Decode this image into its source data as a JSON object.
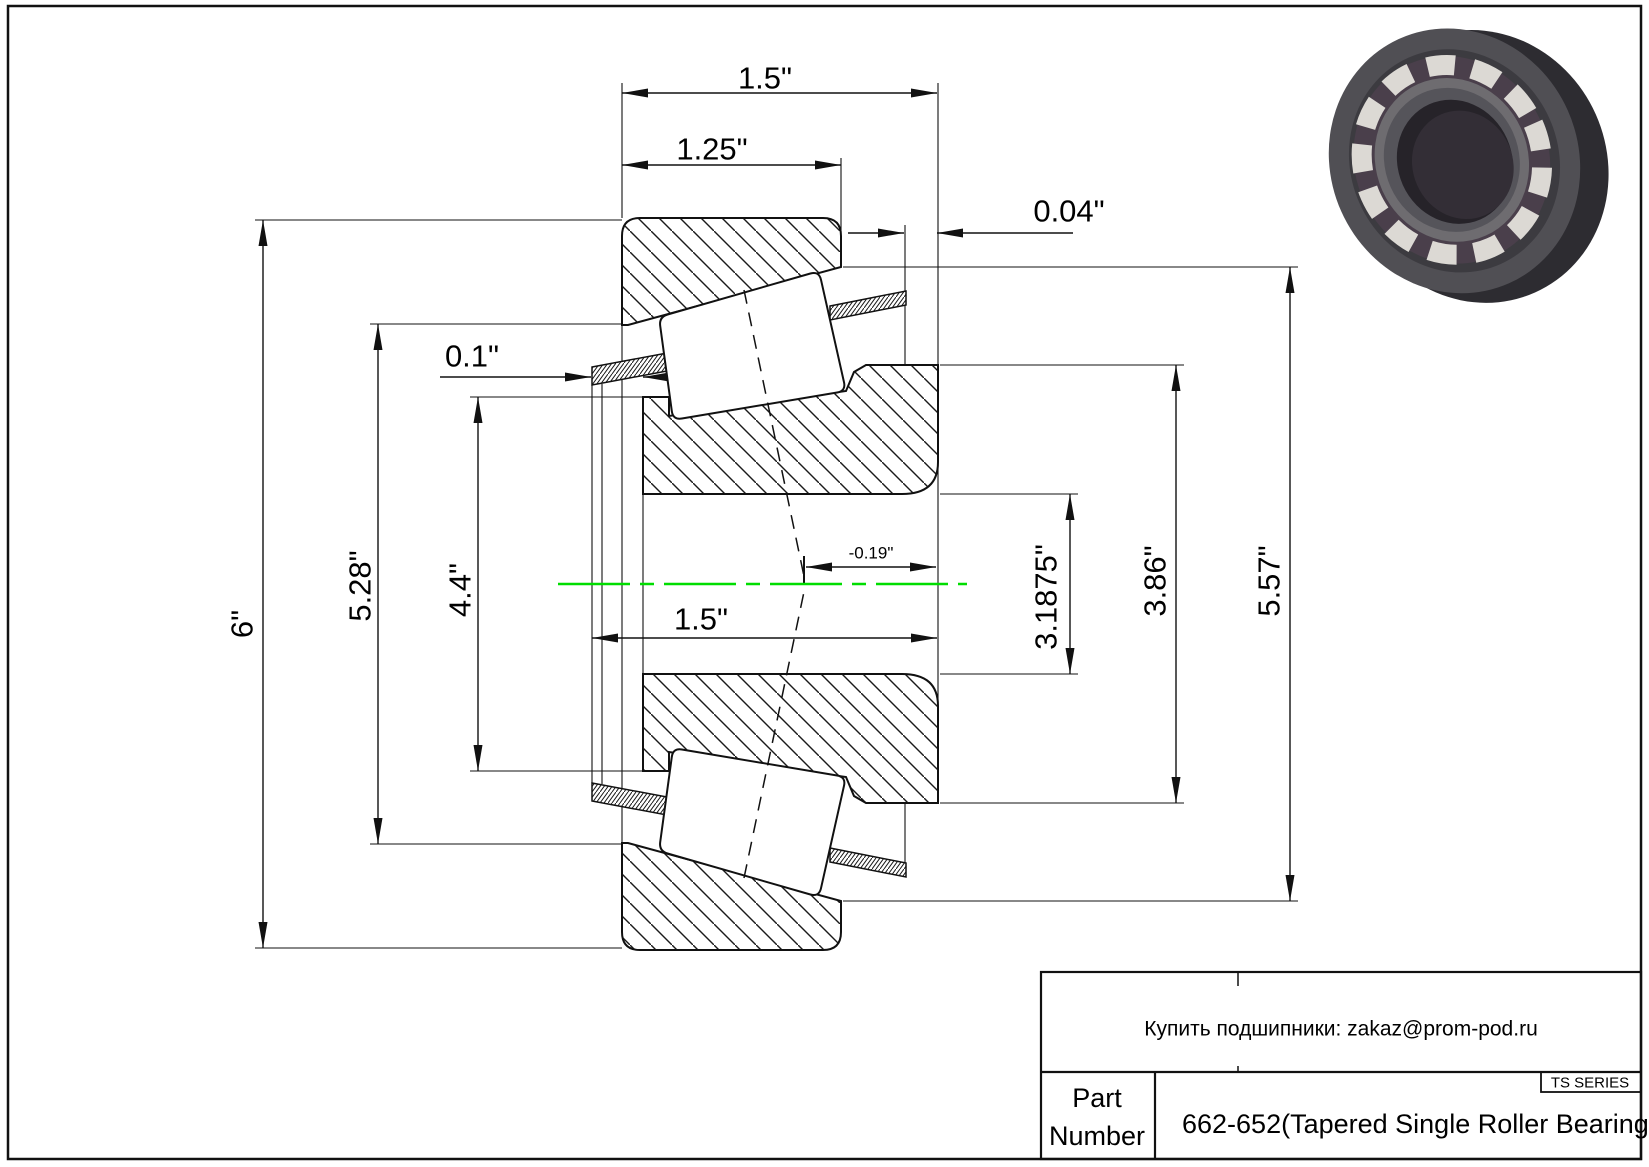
{
  "drawing": {
    "kind": "tapered-roller-bearing-cross-section",
    "dimensions": {
      "overall_width_top": "1.5\"",
      "cup_width": "1.25\"",
      "cage_standout_back": "0.04\"",
      "cage_standout_front": "0.1\"",
      "outer_diameter": "6\"",
      "cup_front_diameter": "5.28\"",
      "cage_front_diameter": "4.4\"",
      "cone_width": "1.5\"",
      "effective_center": "-0.19\"",
      "bore_diameter": "3.1875\"",
      "rib_diameter": "3.86\"",
      "cup_outer_diameter": "5.57\""
    }
  },
  "colors": {
    "centerline": "#00dd00",
    "line": "#000000"
  },
  "title_block": {
    "contact": "Купить подшипники: zakaz@prom-pod.ru",
    "series": "TS SERIES",
    "part_label_line1": "Part",
    "part_label_line2": "Number",
    "part_value": "662-652(Tapered Single Roller Bearings)"
  }
}
